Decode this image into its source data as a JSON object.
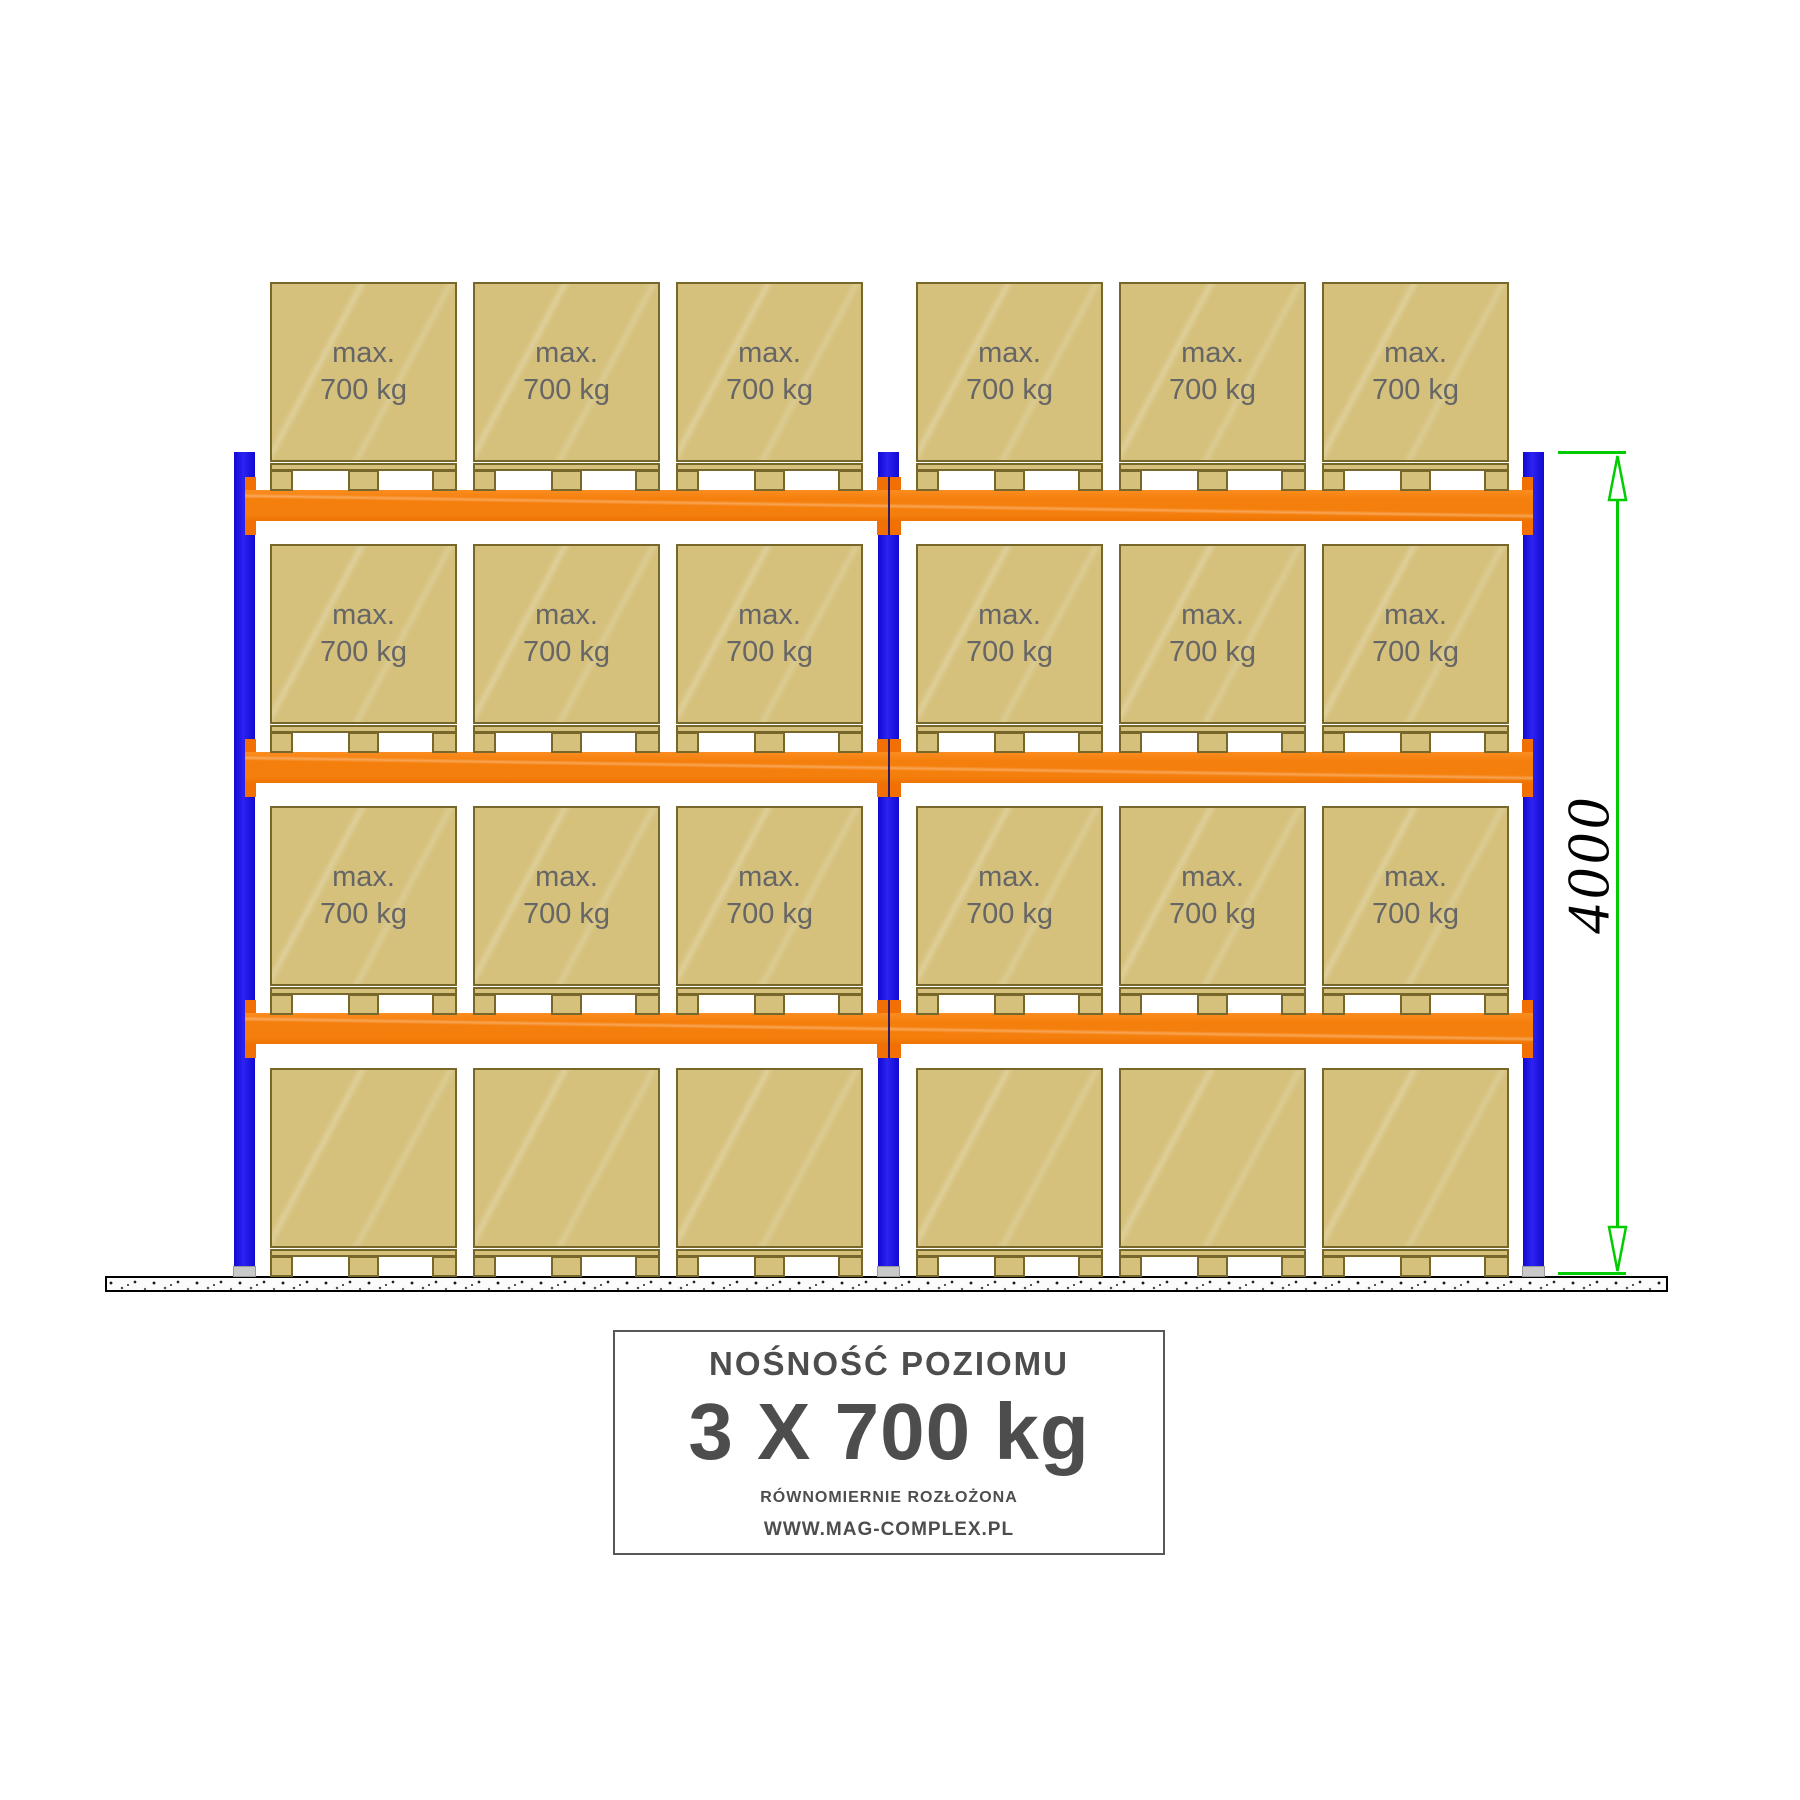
{
  "diagram": {
    "box_label": {
      "line1": "max.",
      "line2": "700 kg"
    },
    "dimension": {
      "value": "4000"
    },
    "info_box": {
      "title": "NOŚNOŚĆ POZIOMU",
      "capacity": "3 X 700 kg",
      "note": "RÓWNOMIERNIE ROZŁOŻONA",
      "website": "WWW.MAG-COMPLEX.PL"
    },
    "structure": {
      "bays": 2,
      "levels": 4,
      "pallets_per_bay_per_level": 3,
      "labeled_levels": 3
    },
    "colors": {
      "upright_blue": "#1409E6",
      "beam_orange": "#F57F0C",
      "box_tan": "#D5C17C",
      "box_border": "#77672A",
      "dimension_green": "#00CC00",
      "box_text_gray": "#666666",
      "info_text_gray": "#4D4D4D"
    }
  }
}
